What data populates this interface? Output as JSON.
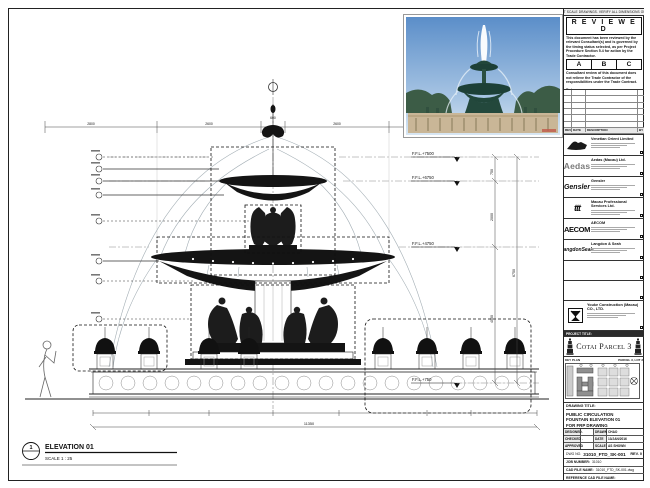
{
  "sheet_note": "DO NOT SCALE DRAWINGS. VERIFY ALL DIMENSIONS ON SITE.",
  "stamp": {
    "title": "R E V I E W E D",
    "body1": "This document has been reviewed by the relevant Consultant(s) and is governed by the timing status selected, as per Project Procedure Section 5.4 for action by the Trade Contractor.",
    "options": [
      "A",
      "B",
      "C"
    ],
    "body2": "Consultant review of this document does not relieve the Trade Contractor of the responsibilities under the Trade Contract.",
    "date_label": "Date :"
  },
  "revision_table": {
    "headers": [
      "REV",
      "DATE",
      "DESCRIPTION",
      "BY"
    ]
  },
  "consultants": [
    {
      "name": "Venetian Orient Limited",
      "logo_text": ""
    },
    {
      "name": "Aedas (Macau) Ltd.",
      "logo_text": "Aedas"
    },
    {
      "name": "Gensler",
      "logo_text": "Gensler"
    },
    {
      "name": "Macau Professional Services Ltd.",
      "logo_text": "ttt"
    },
    {
      "name": "AECOM",
      "logo_text": "AECOM"
    },
    {
      "name": "Langdon & Seah",
      "logo_text": "LangdonSeah"
    }
  ],
  "contractor": {
    "name": "Youke Construction (Macau) CO., LTD."
  },
  "project": {
    "label": "PROJECT TITLE:",
    "name": "Cotai Parcel 3"
  },
  "key_plan": {
    "label": "KEY PLAN",
    "parcel": "PARCEL 3, LOT 2"
  },
  "title_block": {
    "drawing_title_label": "DRAWING TITLE:",
    "drawing_title": "PUBLIC CIRCULATION FOUNTAIN ELEVATION 01 FOR FRP DRAWING",
    "rows": [
      [
        "DESIGNED",
        "-",
        "DRAWN",
        "CHAO"
      ],
      [
        "CHECKED",
        "-",
        "DATE",
        "13/JAN/2016"
      ],
      [
        "APPROVED",
        "-",
        "SCALE",
        "AS SHOWN"
      ]
    ],
    "dwg_no_label": "DWG NO.",
    "dwg_no": "31010_FTD_SK-001",
    "rev": "REV. 0",
    "job_label": "JOB NUMBER:",
    "job_number": "31010",
    "cad_label": "CAD FILE NAME:",
    "cad_file": "31010_FTD_SK-001.dwg",
    "ref_label": "REFERENCE CAD FILE NAME:"
  },
  "drawing": {
    "elevation_label": "ELEVATION 01",
    "elevation_number": "1",
    "scale_label": "SCALE  1 : 25",
    "levels": [
      "F.F.L.+7500",
      "F.F.L.+6750",
      "F.F.L.+4750",
      "F.F.L.+750"
    ],
    "dims_right": [
      "750",
      "2000",
      "4000",
      "6750"
    ],
    "dims_top": [
      "2800",
      "2600",
      "600",
      "2600",
      "2800"
    ],
    "dim_overall": "11350"
  },
  "colors": {
    "line": "#111111",
    "water": "#9aa6ad",
    "sky": "#5b8ec9",
    "stone": "#c9b697",
    "bronze": "#21463a"
  }
}
